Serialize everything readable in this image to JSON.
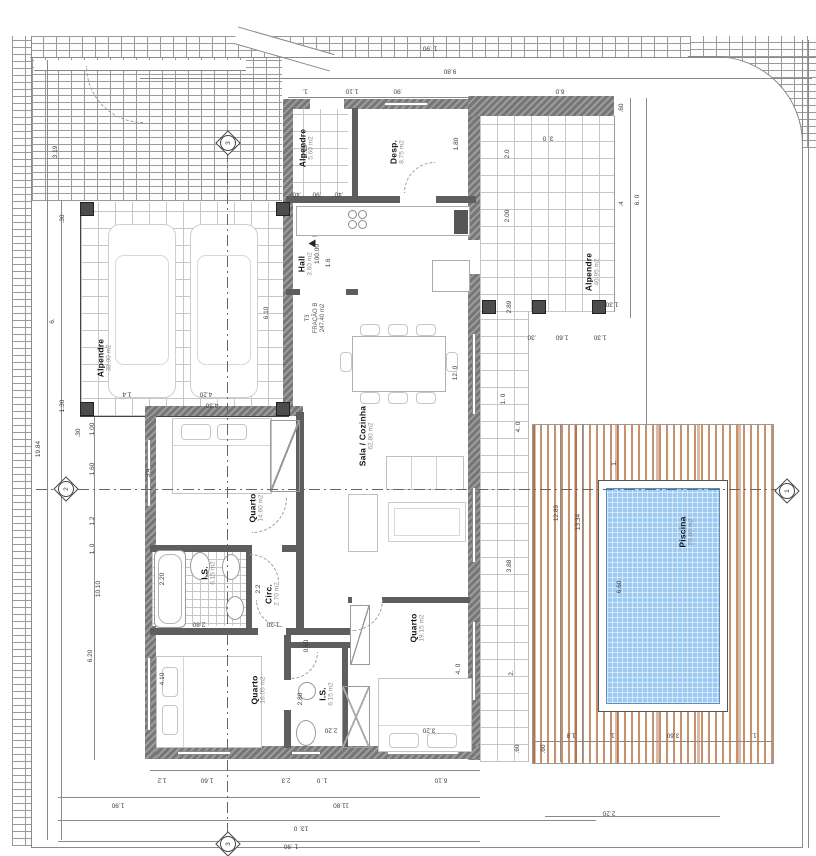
{
  "drawing": {
    "unit": {
      "code": "T3",
      "fraction": "FRAÇÃO B",
      "area": "247.40 m2"
    },
    "level_marker": "100.00",
    "rooms": [
      {
        "id": "carport",
        "name": "Alpendre",
        "area": "38.00 m2"
      },
      {
        "id": "porch-entry",
        "name": "Alpendre",
        "area": "5.60 m2"
      },
      {
        "id": "pantry",
        "name": "Desp.",
        "area": "8.75 m2"
      },
      {
        "id": "hall",
        "name": "Hall",
        "area": "3.60 m2"
      },
      {
        "id": "porch-rear",
        "name": "Alpendre",
        "area": "40.95 m2"
      },
      {
        "id": "living-kitchen",
        "name": "Sala / Cozinha",
        "area": "62.80 m2"
      },
      {
        "id": "bedroom-1",
        "name": "Quarto",
        "area": "14.60 m2"
      },
      {
        "id": "bath-1",
        "name": "I.S.",
        "area": "6.15 m2"
      },
      {
        "id": "circulation",
        "name": "Circ.",
        "area": "2.70 m2"
      },
      {
        "id": "bedroom-2",
        "name": "Quarto",
        "area": "16.05 m2"
      },
      {
        "id": "bath-2",
        "name": "I.S.",
        "area": "6.15 m2"
      },
      {
        "id": "bedroom-3",
        "name": "Quarto",
        "area": "19.15 m2"
      },
      {
        "id": "pool",
        "name": "Piscina",
        "area": "23.80 m2"
      }
    ],
    "section_markers": {
      "right": "1",
      "left": "2",
      "top": "3",
      "bottom": "3"
    },
    "dims": {
      "top": [
        "1 .90",
        "9.80",
        "1.",
        "1.10",
        ".90",
        "6.0"
      ],
      "right": [
        ".60",
        "3. 0",
        "2.0",
        "2.00",
        ".4",
        "6. 0",
        "2.89",
        "1.30",
        ".30",
        "1.60",
        "1.30",
        "1. 0",
        "4. 0",
        "3.88",
        "2.",
        "12.89",
        "13.34",
        "1.",
        "6.60"
      ],
      "bottom": [
        "1.2",
        "1.60",
        "2.3",
        "1. 0",
        "6.10",
        "1.90",
        "11.80",
        "13. 0",
        "1 .90",
        ".60",
        ".60",
        "1.8",
        "1.",
        "3.60",
        "1.",
        "2.20"
      ],
      "left": [
        "3.19",
        ".30",
        "19.84",
        "6.",
        "1.30",
        ".30",
        "1.00",
        "1.60",
        "1.2",
        "1. 0",
        "10.10",
        "6.20",
        "4.10",
        "2.20",
        "3.4"
      ],
      "inner": [
        "6.10",
        "4.20",
        "1.4",
        "3.19",
        "1.80",
        "12. 0",
        "4.30",
        "2.80",
        "1.20",
        "0.60",
        "2.2",
        "2.80",
        "2.20",
        "3.20",
        "4. 0",
        "1.6",
        ".40",
        ".90",
        ".40"
      ]
    },
    "colors": {
      "pool_water": "#9ccaf2",
      "deck_wood": "#c9906c",
      "wall": "#767676"
    }
  }
}
